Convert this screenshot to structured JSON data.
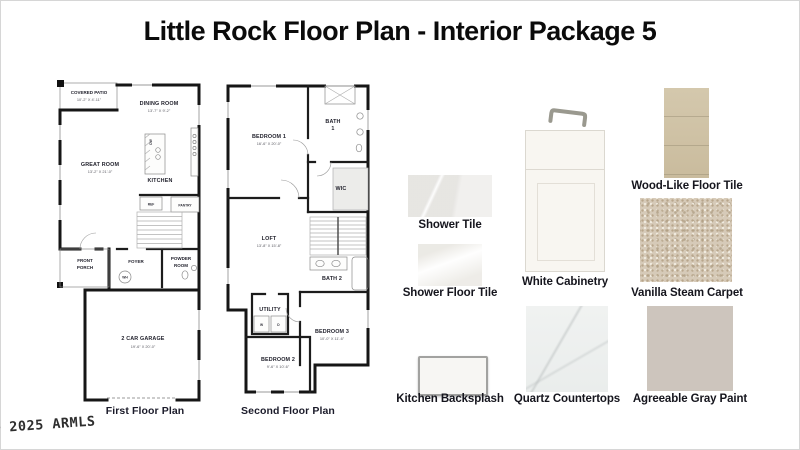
{
  "title": "Little Rock Floor Plan - Interior Package 5",
  "watermark": "© 2025 ARMLS",
  "first_floor": {
    "caption": "First Floor Plan",
    "rooms": {
      "covered_patio": {
        "name": "COVERED PATIO",
        "dims": "10'-2\" X 4'-11\""
      },
      "dining_room": {
        "name": "DINING ROOM",
        "dims": "13'-7\" X 9'-2\""
      },
      "great_room": {
        "name": "GREAT ROOM",
        "dims": "13'-2\" X 21'-0\""
      },
      "kitchen": {
        "name": "KITCHEN"
      },
      "dw": {
        "name": "DW"
      },
      "ref": {
        "name": "REF"
      },
      "pantry": {
        "name": "PANTRY"
      },
      "front_porch": {
        "line1": "FRONT",
        "line2": "PORCH"
      },
      "foyer": {
        "name": "FOYER"
      },
      "powder_room": {
        "line1": "POWDER",
        "line2": "ROOM"
      },
      "wh": {
        "name": "WH"
      },
      "garage": {
        "name": "2 CAR GARAGE",
        "dims": "19'-6\" X 20'-0\""
      }
    }
  },
  "second_floor": {
    "caption": "Second Floor Plan",
    "rooms": {
      "bedroom1": {
        "name": "BEDROOM 1",
        "dims": "16'-6\" X 20'-0\""
      },
      "bath1": {
        "line1": "BATH",
        "line2": "1"
      },
      "wic": {
        "name": "WIC"
      },
      "loft": {
        "name": "LOFT",
        "dims": "13'-8\" X 15'-8\""
      },
      "bath2": {
        "name": "BATH 2"
      },
      "utility": {
        "name": "UTILITY"
      },
      "washer": {
        "name": "W"
      },
      "dryer": {
        "name": "D"
      },
      "bedroom3": {
        "name": "BEDROOM 3",
        "dims": "10'-0\" X 11'-6\""
      },
      "bedroom2": {
        "name": "BEDROOM 2",
        "dims": "9'-6\" X 10'-6\""
      }
    }
  },
  "swatches": {
    "shower_tile": {
      "label": "Shower Tile",
      "color": "#f1f0ee"
    },
    "shower_floor_tile": {
      "label": "Shower Floor Tile",
      "color": "#f6f5f2"
    },
    "white_cabinetry": {
      "label": "White Cabinetry",
      "color": "#f8f6f1",
      "handle_color": "#9a998f"
    },
    "wood_floor_tile": {
      "label": "Wood-Like Floor Tile",
      "color": "#cfc2a5"
    },
    "vanilla_carpet": {
      "label": "Vanilla Steam Carpet",
      "color": "#d6cab8"
    },
    "kitchen_backsplash": {
      "label": "Kitchen Backsplash",
      "color": "#f7f6f3"
    },
    "quartz_countertops": {
      "label": "Quartz Countertops",
      "color": "#eef0ef"
    },
    "agreeable_gray": {
      "label": "Agreeable Gray Paint",
      "color": "#cdc5bd"
    }
  }
}
